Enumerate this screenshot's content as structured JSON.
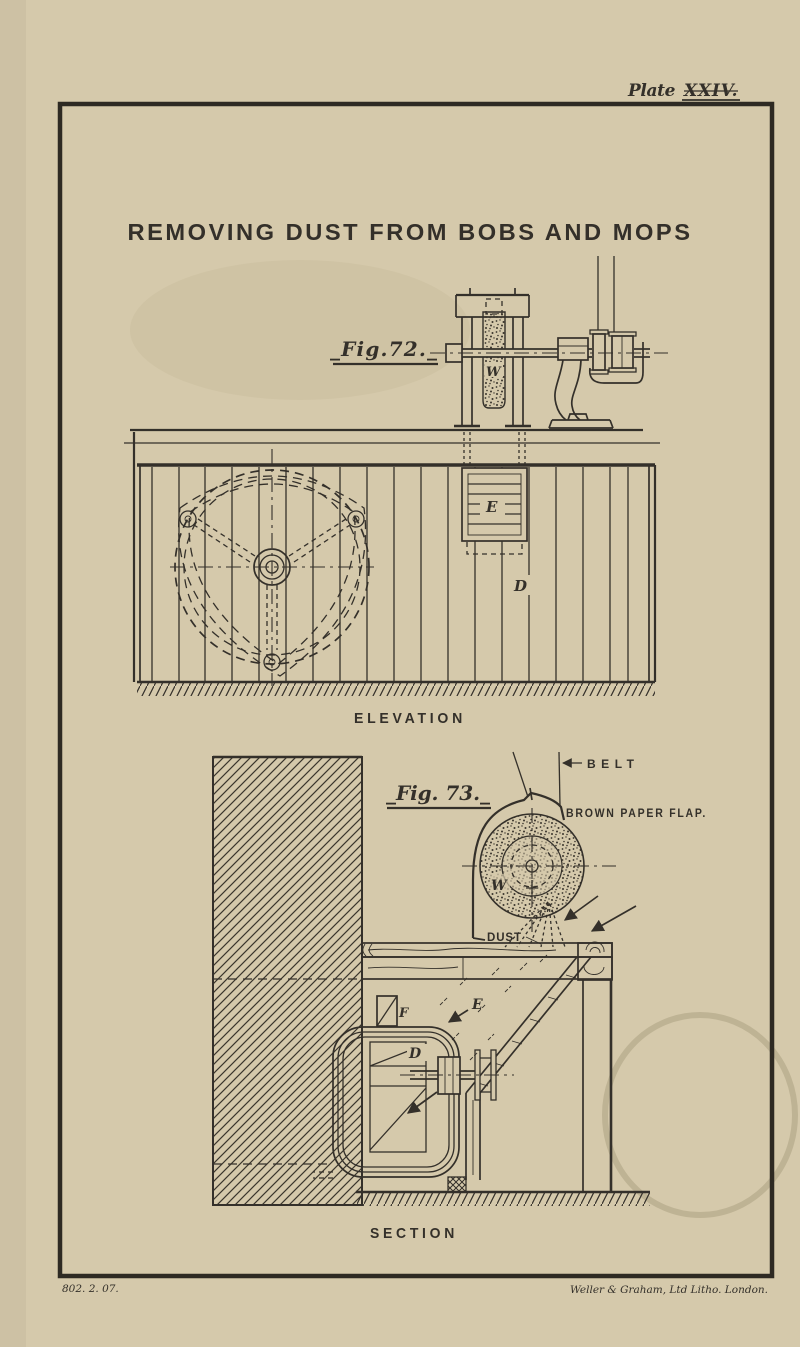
{
  "plate": {
    "header_word": "Plate",
    "header_numeral": "XXIV.",
    "title": "REMOVING DUST FROM BOBS AND MOPS",
    "imprint_number": "802. 2. 07.",
    "imprint_printer": "Weller & Graham, Ltd Litho. London."
  },
  "figure_elevation": {
    "label": "_Fig.72._",
    "caption": "ELEVATION",
    "parts": {
      "wheel": "W",
      "hanging_box": "E",
      "screen": "D"
    }
  },
  "figure_section": {
    "label": "_Fig. 73._",
    "caption": "SECTION",
    "annotations": {
      "belt": "BELT",
      "flap": "BROWN PAPER FLAP.",
      "dust": "DUST"
    },
    "parts": {
      "wheel": "W",
      "flue_box": "F",
      "trunk": "D",
      "chamber": "E"
    }
  },
  "colors": {
    "paper": "#d5c9ab",
    "ink": "#34302a"
  }
}
